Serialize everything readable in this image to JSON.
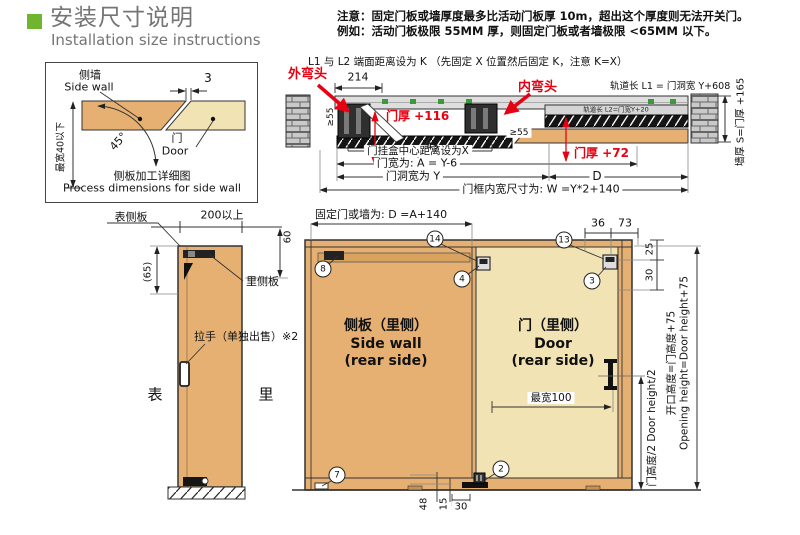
{
  "colors": {
    "accent_green": "#6fb52d",
    "dim_red": "#e60012",
    "wood": "#e5b072",
    "wood_light": "#f2e3b4"
  },
  "header": {
    "title_zh": "安装尺寸说明",
    "title_en": "Installation size instructions"
  },
  "notes": {
    "line1": "注意：固定门板或墙厚度最多比活动门板厚 10m，超出这个厚度则无法开关门。",
    "line2": "例如：活动门板极限 55MM 厚，则固定门板或者墙极限 <65MM 以下。"
  },
  "side_detail": {
    "wall_zh": "侧墙",
    "wall_en": "Side wall",
    "gap": "3",
    "angle": "45°",
    "door_zh": "门",
    "door_en": "Door",
    "max_width": "最宽40以下",
    "caption_zh": "侧板加工详细图",
    "caption_en": "Process dimensions for side wall"
  },
  "plan": {
    "title": "L1 与 L2 端面距离设为 K （先固定 X 位置然后固定 K，注意 K=X）",
    "outer_elbow": "外弯头",
    "inner_elbow": "内弯头",
    "dim_214": "214",
    "track_l1": "轨道长 L1 = 门洞宽 Y+608",
    "track_l2": "轨道长 L2=门宽Y+20",
    "thick_116": "门厚 +116",
    "thick_72": "门厚 +72",
    "min55_left": "≥55",
    "min55_right": "≥55",
    "hanger_x": "门挂盒中心距离设为X",
    "door_width": "门宽为: A = Y-6",
    "opening_width": "门洞宽为 Y",
    "dim_d": "D",
    "frame_width": "门框内宽尺寸为: W =Y*2+140",
    "angle": "45°",
    "wall_thickness": "墙厚 S=门厚 +165"
  },
  "elevation": {
    "front_panel": "表侧板",
    "min200": "200以上",
    "dim60": "60",
    "dim65": "(65)",
    "rear_panel": "里侧板",
    "handle_note": "拉手（单独出售）※2",
    "front": "表",
    "rear": "里",
    "fixed_dim": "固定门或墙为: D =A+140",
    "dim36": "36",
    "dim73": "73",
    "dim25": "25",
    "dim30_top": "30",
    "side_wall_zh": "侧板（里侧）",
    "side_wall_en1": "Side wall",
    "side_wall_en2": "(rear side)",
    "door_zh": "门（里侧）",
    "door_en1": "Door",
    "door_en2": "(rear side)",
    "max100": "最宽100",
    "half_height": "门高度/2  Door height/2",
    "opening_height_zh": "开口高度=门高度+75",
    "opening_height_en": "Opening height=Door height+75",
    "dim48": "48",
    "dim15": "15",
    "dim30_bottom": "30",
    "badges": {
      "b2": "2",
      "b3": "3",
      "b4": "4",
      "b7": "7",
      "b8": "8",
      "b13": "13",
      "b14": "14"
    }
  }
}
